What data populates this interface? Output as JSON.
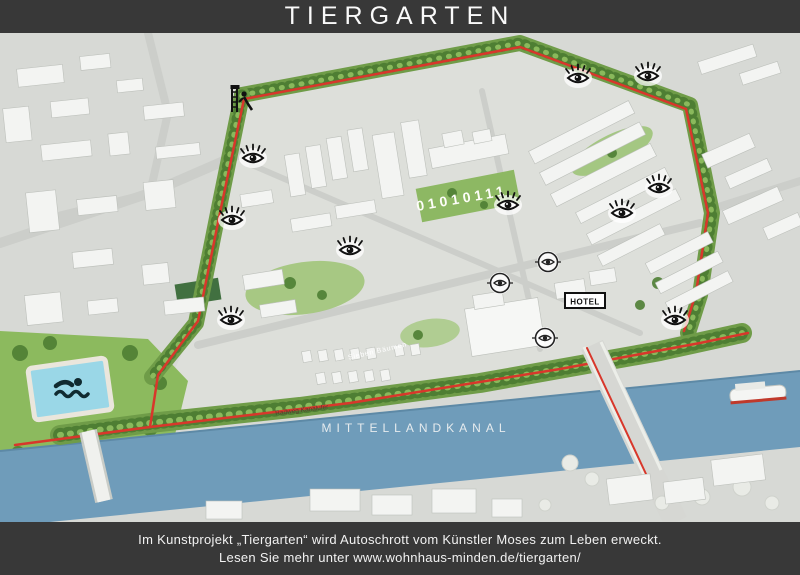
{
  "header": {
    "title": "TIERGARTEN"
  },
  "footer": {
    "line1": "Im Kunstprojekt „Tiergarten“ wird Autoschrott vom Künstler Moses zum Leben erweckt.",
    "line2": "Lesen Sie mehr unter www.wohnhaus-minden.de/tiergarten/"
  },
  "map": {
    "canal_label": "MITTELLANDKANAL",
    "hotel_label": "HOTEL",
    "courtyard_text": "01010111",
    "street_labels": [
      {
        "text": "Radweg Kanalufer"
      },
      {
        "text": "Sieben Bäumen"
      }
    ],
    "markers": [
      {
        "type": "eye",
        "x": 253,
        "y": 125
      },
      {
        "type": "eye",
        "x": 232,
        "y": 187
      },
      {
        "type": "eye",
        "x": 350,
        "y": 217
      },
      {
        "type": "eye",
        "x": 508,
        "y": 172
      },
      {
        "type": "eye",
        "x": 578,
        "y": 45
      },
      {
        "type": "eye",
        "x": 648,
        "y": 43
      },
      {
        "type": "eye",
        "x": 659,
        "y": 155
      },
      {
        "type": "eye",
        "x": 622,
        "y": 180
      },
      {
        "type": "eye",
        "x": 675,
        "y": 287
      },
      {
        "type": "eye",
        "x": 231,
        "y": 287
      },
      {
        "type": "circled-eye",
        "x": 548,
        "y": 229
      },
      {
        "type": "circled-eye",
        "x": 500,
        "y": 250
      },
      {
        "type": "circled-eye",
        "x": 545,
        "y": 305
      },
      {
        "type": "playground",
        "x": 240,
        "y": 67
      },
      {
        "type": "swimmer",
        "x": 70,
        "y": 356
      }
    ],
    "colors": {
      "bar_bg": "#383838",
      "text": "#f2f2f2",
      "canal_blue": "#6f9cba",
      "pool_blue": "#9ad7e7",
      "path_red": "#d8372b",
      "tree_green": "#4e7e33",
      "park_green": "#8cba5e",
      "ground": "#d7d9d5"
    }
  }
}
